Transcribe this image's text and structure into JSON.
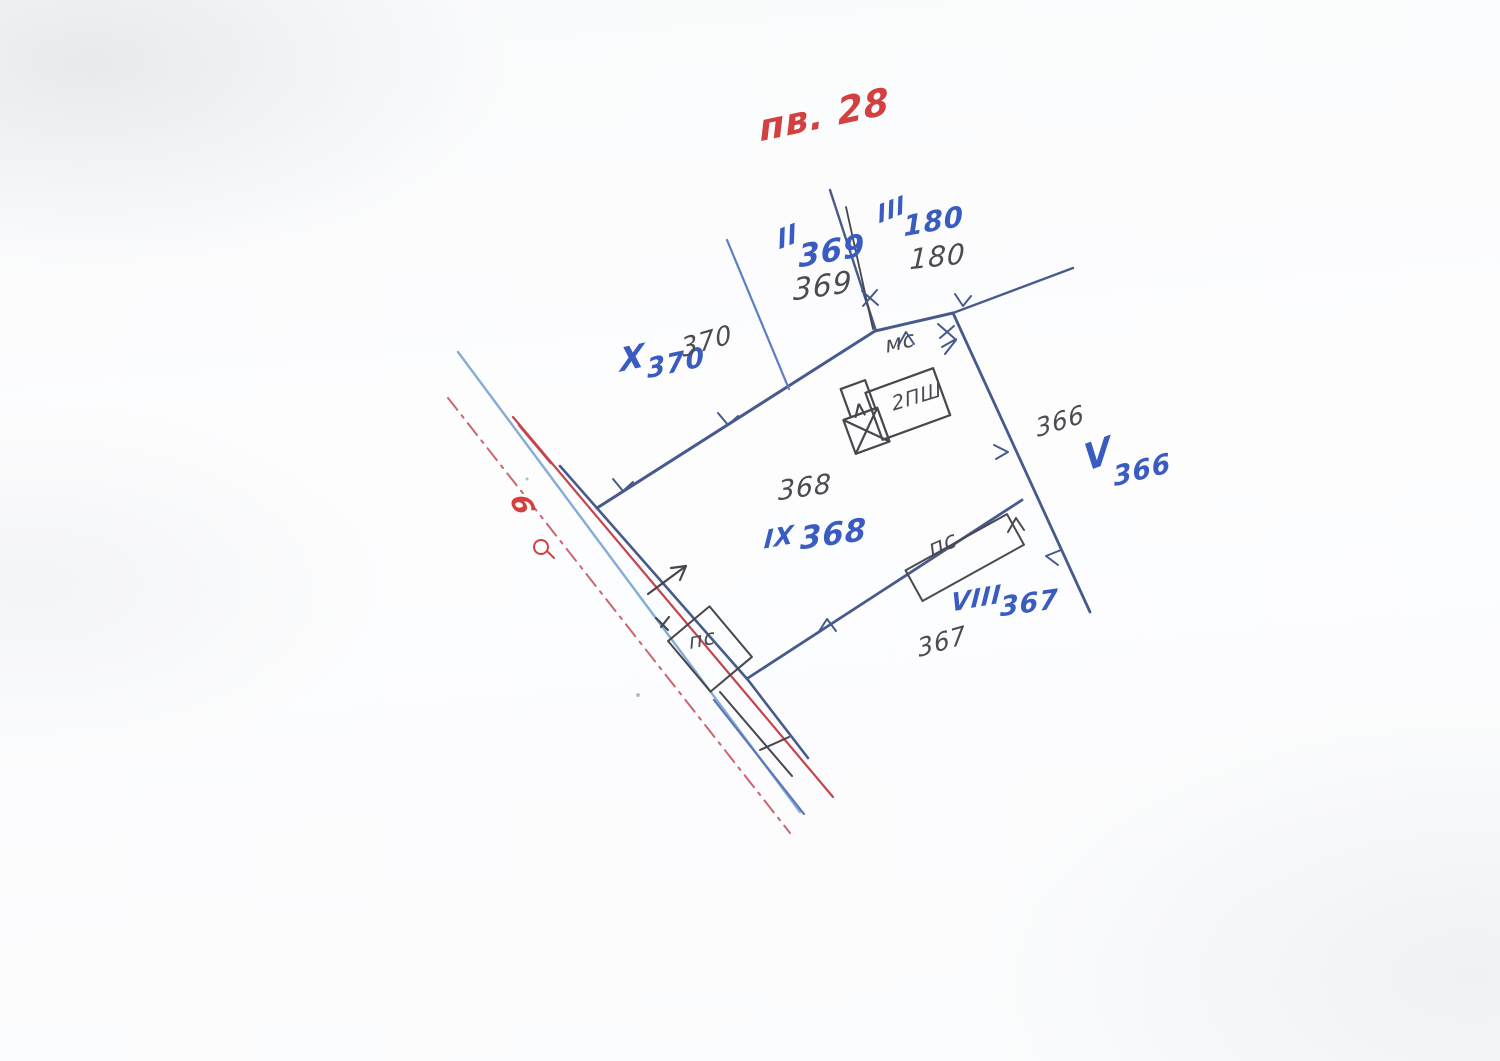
{
  "document": {
    "type": "hand-drawn cadastral sketch (scanned)",
    "plan_number": "пв. 28"
  },
  "colors": {
    "blue_ink": "#3a5cc0",
    "boundary_blue": "#475a8c",
    "street_light_blue": "#85abd7",
    "pencil_black": "#4b4b52",
    "red_line": "#c4454f",
    "red_ink": "#d24040"
  },
  "symbols": [
    {
      "name": "red-ring-symbol",
      "meaning": "survey point ring"
    },
    {
      "name": "building-x-square",
      "meaning": "crossed annex square on building"
    }
  ],
  "annotations": [
    {
      "name": "plan-number",
      "text": "пв. 28"
    },
    {
      "name": "roman-ii",
      "text": "II"
    },
    {
      "name": "num-369-blue",
      "text": "369"
    },
    {
      "name": "num-369-black",
      "text": "369"
    },
    {
      "name": "roman-iii",
      "text": "III"
    },
    {
      "name": "num-180-blue",
      "text": "180"
    },
    {
      "name": "num-180-black",
      "text": "180"
    },
    {
      "name": "roman-x",
      "text": "X"
    },
    {
      "name": "num-370-blue",
      "text": "370"
    },
    {
      "name": "num-370-black",
      "text": "370"
    },
    {
      "name": "label-ms",
      "text": "мс"
    },
    {
      "name": "label-2psh",
      "text": "2ПШ"
    },
    {
      "name": "num-366-black",
      "text": "366"
    },
    {
      "name": "roman-v",
      "text": "V"
    },
    {
      "name": "num-366-blue",
      "text": "366"
    },
    {
      "name": "num-368-black",
      "text": "368"
    },
    {
      "name": "roman-ix",
      "text": "IX"
    },
    {
      "name": "num-368-blue",
      "text": "368"
    },
    {
      "name": "label-pc-right",
      "text": "пс"
    },
    {
      "name": "roman-viii",
      "text": "VIII"
    },
    {
      "name": "num-367-blue",
      "text": "367"
    },
    {
      "name": "num-367-black",
      "text": "367"
    },
    {
      "name": "label-pc-left",
      "text": "пс"
    },
    {
      "name": "num-6-red",
      "text": "6"
    }
  ]
}
